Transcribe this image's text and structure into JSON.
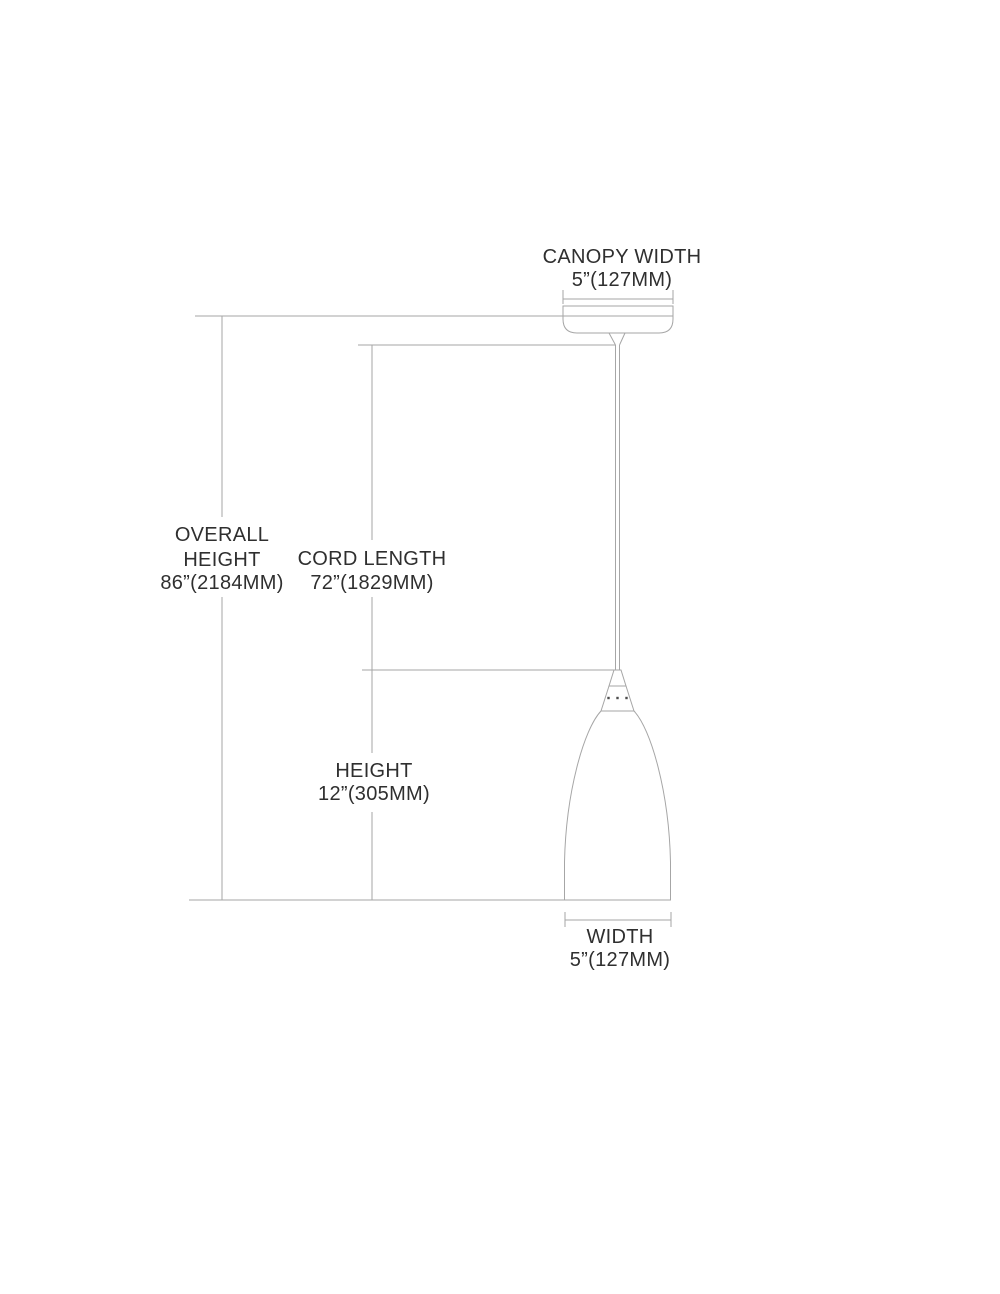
{
  "diagram": {
    "canopy_width": {
      "label": "CANOPY WIDTH",
      "value": "5”(127MM)"
    },
    "overall_height": {
      "label_line1": "OVERALL",
      "label_line2": "HEIGHT",
      "value": "86”(2184MM)"
    },
    "cord_length": {
      "label": "CORD LENGTH",
      "value": "72”(1829MM)"
    },
    "shade_height": {
      "label": "HEIGHT",
      "value": "12”(305MM)"
    },
    "shade_width": {
      "label": "WIDTH",
      "value": "5”(127MM)"
    }
  },
  "colors": {
    "line": "#a6a6a6",
    "text": "#2f2f2f",
    "screw": "#4d4d4d",
    "background": "#ffffff"
  }
}
